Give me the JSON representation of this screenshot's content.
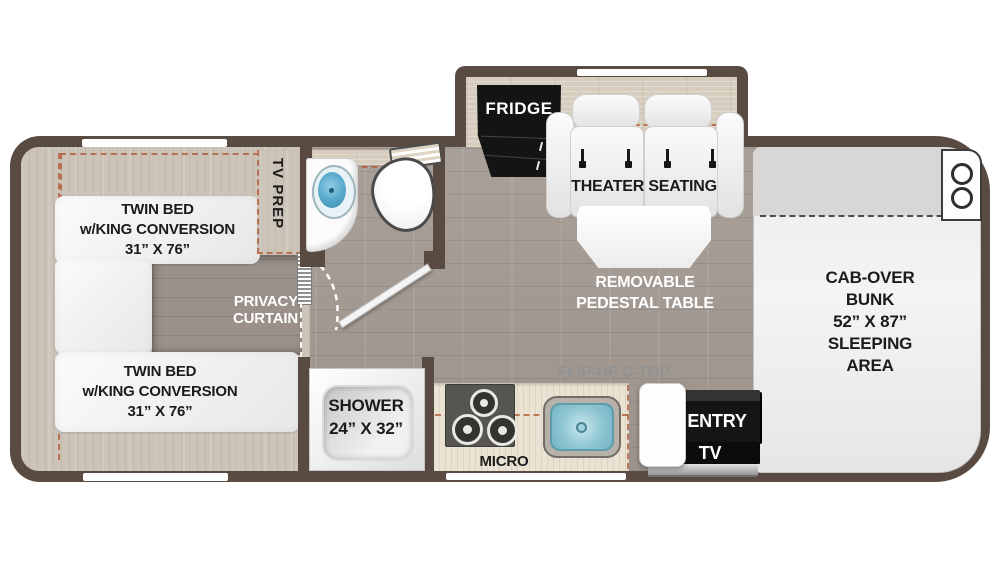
{
  "plan_title": "Class C motorhome floor plan",
  "palette": {
    "wall": "#5a4b42",
    "floor": "#a49b93",
    "bedroom_wood": "#ccc4b9",
    "kitchen_counter": "#eae2d3",
    "slide_platform": "#d7cdbf",
    "accent_dash": "#b25c38",
    "fridge_black": "#141414",
    "sink_blue": "#55a6c9",
    "text_black": "#1b1b1b",
    "text_white": "#ffffff",
    "text_gray": "#929292"
  },
  "labels": {
    "bed_top": {
      "line1": "TWIN BED",
      "line2": "w/KING CONVERSION",
      "line3": "31” X 76”"
    },
    "bed_bottom": {
      "line1": "TWIN BED",
      "line2": "w/KING CONVERSION",
      "line3": "31” X 76”"
    },
    "tv_prep": "TV PREP",
    "privacy_curtain": {
      "line1": "PRIVACY",
      "line2": "CURTAIN"
    },
    "fridge": "FRIDGE",
    "theater_seating": "THEATER SEATING",
    "pedestal_table": {
      "line1": "REMOVABLE",
      "line2": "PEDESTAL TABLE"
    },
    "cab_over_bunk": {
      "line1": "CAB-OVER",
      "line2": "BUNK",
      "line3": "52” X 87”",
      "line4": "SLEEPING",
      "line5": "AREA"
    },
    "shower": {
      "line1": "SHOWER",
      "line2": "24” X 32”"
    },
    "micro": "MICRO",
    "flip_up_ctop": "FLIP-UP C-TOP",
    "entry": "ENTRY",
    "tv": "TV"
  }
}
